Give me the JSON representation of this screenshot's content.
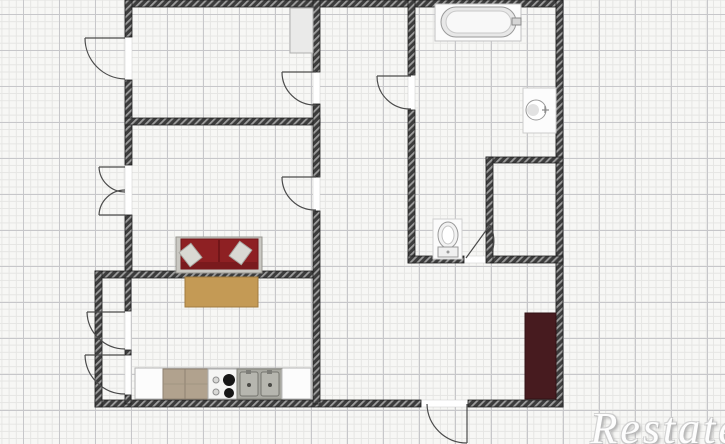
{
  "watermark": {
    "text": "Restate"
  },
  "plan": {
    "width": 725,
    "height": 444,
    "palette": {
      "wall_fill": "#3c3c3c",
      "wall_hatch": "#9d9d9d",
      "wall_edge": "#1e1e1e",
      "door": "#4b4b4b",
      "threshold": "#ffffff"
    },
    "walls": [
      {
        "x": 125,
        "y": 0,
        "w": 438,
        "h": 7
      },
      {
        "x": 556,
        "y": 0,
        "w": 7,
        "h": 407
      },
      {
        "x": 95,
        "y": 400,
        "w": 326,
        "h": 7
      },
      {
        "x": 468,
        "y": 400,
        "w": 95,
        "h": 7
      },
      {
        "x": 125,
        "y": 0,
        "w": 7,
        "h": 37
      },
      {
        "x": 125,
        "y": 80,
        "w": 7,
        "h": 85
      },
      {
        "x": 125,
        "y": 215,
        "w": 7,
        "h": 62
      },
      {
        "x": 95,
        "y": 271,
        "w": 225,
        "h": 7
      },
      {
        "x": 95,
        "y": 271,
        "w": 7,
        "h": 136
      },
      {
        "x": 125,
        "y": 118,
        "w": 195,
        "h": 7
      },
      {
        "x": 313,
        "y": 0,
        "w": 7,
        "h": 72
      },
      {
        "x": 313,
        "y": 104,
        "w": 7,
        "h": 73
      },
      {
        "x": 313,
        "y": 211,
        "w": 7,
        "h": 193
      },
      {
        "x": 408,
        "y": 0,
        "w": 7,
        "h": 75
      },
      {
        "x": 408,
        "y": 110,
        "w": 7,
        "h": 153
      },
      {
        "x": 408,
        "y": 256,
        "w": 56,
        "h": 7
      },
      {
        "x": 492,
        "y": 256,
        "w": 71,
        "h": 7
      },
      {
        "x": 486,
        "y": 157,
        "w": 77,
        "h": 6
      },
      {
        "x": 486,
        "y": 157,
        "w": 7,
        "h": 106
      },
      {
        "x": 125,
        "y": 278,
        "w": 6,
        "h": 33
      },
      {
        "x": 125,
        "y": 350,
        "w": 6,
        "h": 5
      },
      {
        "x": 125,
        "y": 395,
        "w": 6,
        "h": 9
      }
    ],
    "openings": [
      {
        "x": 125,
        "y": 37,
        "w": 7,
        "h": 43
      },
      {
        "x": 125,
        "y": 165,
        "w": 7,
        "h": 50
      },
      {
        "x": 313,
        "y": 72,
        "w": 7,
        "h": 32
      },
      {
        "x": 313,
        "y": 177,
        "w": 7,
        "h": 34
      },
      {
        "x": 408,
        "y": 75,
        "w": 7,
        "h": 35
      },
      {
        "x": 464,
        "y": 256,
        "w": 28,
        "h": 7
      },
      {
        "x": 125,
        "y": 311,
        "w": 6,
        "h": 39
      },
      {
        "x": 125,
        "y": 355,
        "w": 6,
        "h": 40
      },
      {
        "x": 421,
        "y": 400,
        "w": 47,
        "h": 7
      }
    ],
    "doors": [
      {
        "name": "door-upper-balcony",
        "leaf": [
          125,
          38,
          85,
          38
        ],
        "arc": {
          "from": [
            85,
            38
          ],
          "to": [
            125,
            79
          ],
          "r": 41,
          "sweep": 0
        }
      },
      {
        "name": "door-top-left-room",
        "leaf": [
          316,
          72,
          282,
          72
        ],
        "arc": {
          "from": [
            282,
            72
          ],
          "to": [
            316,
            105
          ],
          "r": 33,
          "sweep": 0
        }
      },
      {
        "name": "door-living-room",
        "leaf": [
          316,
          177,
          282,
          177
        ],
        "arc": {
          "from": [
            282,
            177
          ],
          "to": [
            316,
            210
          ],
          "r": 33,
          "sweep": 0
        }
      },
      {
        "name": "door-bathroom",
        "leaf": [
          411,
          76,
          377,
          76
        ],
        "arc": {
          "from": [
            377,
            76
          ],
          "to": [
            411,
            109
          ],
          "r": 33,
          "sweep": 0
        }
      },
      {
        "name": "door-bathroom-inner",
        "leaf": [
          466,
          258,
          490,
          225
        ],
        "arc": {
          "from": [
            490,
            225
          ],
          "to": [
            492,
            252
          ],
          "r": 34,
          "sweep": 1
        }
      },
      {
        "name": "door-french-upper-leaf",
        "leaf": [
          125,
          167,
          99,
          167
        ],
        "arc": {
          "from": [
            99,
            167
          ],
          "to": [
            125,
            192
          ],
          "r": 26,
          "sweep": 0
        }
      },
      {
        "name": "door-french-lower-leaf",
        "leaf": [
          125,
          215,
          99,
          215
        ],
        "arc": {
          "from": [
            99,
            215
          ],
          "to": [
            125,
            190
          ],
          "r": 26,
          "sweep": 1
        }
      },
      {
        "name": "door-closet-upper",
        "leaf": [
          125,
          312,
          87,
          312
        ],
        "arc": {
          "from": [
            87,
            312
          ],
          "to": [
            125,
            349
          ],
          "r": 38,
          "sweep": 0
        }
      },
      {
        "name": "door-closet-lower",
        "leaf": [
          125,
          355,
          85,
          355
        ],
        "arc": {
          "from": [
            85,
            355
          ],
          "to": [
            125,
            394
          ],
          "r": 40,
          "sweep": 0
        }
      },
      {
        "name": "door-entrance",
        "leaf": [
          467,
          404,
          467,
          443
        ],
        "arc": {
          "from": [
            467,
            443
          ],
          "to": [
            427,
            404
          ],
          "r": 40,
          "sweep": 1
        }
      }
    ],
    "furniture": [
      {
        "name": "cabinet",
        "shape": "rect",
        "x": 290,
        "y": 8,
        "w": 23,
        "h": 45,
        "fill": "#eaeae9",
        "stroke": "#b0b0b0"
      },
      {
        "name": "bathtub-base",
        "shape": "rect",
        "x": 435,
        "y": 4,
        "w": 86,
        "h": 37,
        "fill": "#fbfbfb",
        "stroke": "#c2c2c2"
      },
      {
        "name": "bathtub-rim",
        "shape": "rect",
        "x": 441,
        "y": 7,
        "w": 75,
        "h": 30,
        "rx": 15,
        "fill": "#e8e8e8",
        "stroke": "#9a9a9a"
      },
      {
        "name": "bathtub-inner",
        "shape": "rect",
        "x": 446,
        "y": 11,
        "w": 65,
        "h": 22,
        "rx": 11,
        "fill": "#f8f8f8",
        "stroke": "#c9c9c9"
      },
      {
        "name": "bathtub-faucet",
        "shape": "rect",
        "x": 512,
        "y": 18,
        "w": 9,
        "h": 7,
        "fill": "#d6d6d6",
        "stroke": "#8a8a8a"
      },
      {
        "name": "boiler-box",
        "shape": "rect",
        "x": 523,
        "y": 88,
        "w": 33,
        "h": 45,
        "fill": "#fcfcfc",
        "stroke": "#cccccc"
      },
      {
        "name": "boiler-dial",
        "shape": "circle",
        "cx": 536,
        "cy": 110,
        "r": 10,
        "fill": "#ffffff",
        "stroke": "#9a9a9a"
      },
      {
        "name": "boiler-dial-shade",
        "shape": "circle",
        "cx": 533,
        "cy": 110,
        "r": 6,
        "fill": "#e2e2e2",
        "stroke": "none"
      },
      {
        "name": "boiler-valve-h",
        "shape": "line",
        "x1": 542,
        "y1": 110,
        "x2": 549,
        "y2": 110,
        "stroke": "#8a8a8a",
        "sw": 1.2
      },
      {
        "name": "boiler-valve-v",
        "shape": "line",
        "x1": 545,
        "y1": 106,
        "x2": 545,
        "y2": 113,
        "stroke": "#8a8a8a",
        "sw": 1.2
      },
      {
        "name": "toilet-base",
        "shape": "rect",
        "x": 433,
        "y": 219,
        "w": 29,
        "h": 40,
        "fill": "#fbfbfb",
        "stroke": "#cfcfcf"
      },
      {
        "name": "toilet-bowl",
        "shape": "ellipse",
        "cx": 448,
        "cy": 235,
        "rx": 10,
        "ry": 13,
        "fill": "#f2f2f2",
        "stroke": "#9a9a9a"
      },
      {
        "name": "toilet-bowl-inner",
        "shape": "ellipse",
        "cx": 448,
        "cy": 235,
        "rx": 6,
        "ry": 9,
        "fill": "#ffffff",
        "stroke": "#c4c4c4"
      },
      {
        "name": "toilet-tank",
        "shape": "rect",
        "x": 438,
        "y": 247,
        "w": 20,
        "h": 10,
        "fill": "#f0f0f0",
        "stroke": "#9a9a9a"
      },
      {
        "name": "toilet-button",
        "shape": "circle",
        "cx": 448,
        "cy": 252,
        "r": 1.5,
        "fill": "#9a9a9a",
        "stroke": "none"
      },
      {
        "name": "sofa-frame",
        "shape": "rect",
        "x": 176,
        "y": 237,
        "w": 86,
        "h": 36,
        "fill": "#c9c8c2",
        "stroke": "#96958f"
      },
      {
        "name": "sofa-cushions",
        "shape": "rect",
        "x": 181,
        "y": 239,
        "w": 77,
        "h": 30,
        "fill": "#8e2023",
        "stroke": "#701418"
      },
      {
        "name": "sofa-cushion-split",
        "shape": "line",
        "x1": 219,
        "y1": 240,
        "x2": 219,
        "y2": 268,
        "stroke": "#5f1013",
        "sw": 1.2
      },
      {
        "name": "sofa-back",
        "shape": "rect",
        "x": 181,
        "y": 262,
        "w": 77,
        "h": 7,
        "fill": "#7a1a1d",
        "stroke": "none"
      },
      {
        "name": "sofa-pillow-left",
        "shape": "rect",
        "x": 183,
        "y": 246,
        "w": 15,
        "h": 18,
        "rotate": -38,
        "fill": "#d9d9d3",
        "stroke": "#a8a8a2"
      },
      {
        "name": "sofa-pillow-right",
        "shape": "rect",
        "x": 233,
        "y": 244,
        "w": 15,
        "h": 18,
        "rotate": 36,
        "fill": "#d9d9d3",
        "stroke": "#a8a8a2"
      },
      {
        "name": "table-dining",
        "shape": "rect",
        "x": 185,
        "y": 277,
        "w": 73,
        "h": 30,
        "fill": "#c49a55",
        "stroke": "#a07b3e"
      },
      {
        "name": "kitchen-counter",
        "shape": "rect",
        "x": 135,
        "y": 368,
        "w": 176,
        "h": 31,
        "fill": "#fcfcfc",
        "stroke": "#b5b5b5"
      },
      {
        "name": "kitchen-cabinet-wood",
        "shape": "rect",
        "x": 163,
        "y": 369,
        "w": 45,
        "h": 30,
        "fill": "#b1a28e",
        "stroke": "#8e8171"
      },
      {
        "name": "kitchen-cabinet-split-v",
        "shape": "line",
        "x1": 185,
        "y1": 369,
        "x2": 185,
        "y2": 399,
        "stroke": "#8e8171",
        "sw": 1
      },
      {
        "name": "kitchen-cabinet-split-h",
        "shape": "line",
        "x1": 163,
        "y1": 384,
        "x2": 208,
        "y2": 384,
        "stroke": "#9d907d",
        "sw": 0.8
      },
      {
        "name": "kitchen-stove",
        "shape": "rect",
        "x": 208,
        "y": 369,
        "w": 29,
        "h": 30,
        "fill": "#f5f5f4",
        "stroke": "#adadad"
      },
      {
        "name": "stove-burner-small-top",
        "shape": "circle",
        "cx": 216,
        "cy": 380,
        "r": 3,
        "fill": "#d8d8d6",
        "stroke": "#8f8f8f"
      },
      {
        "name": "stove-burner-large-top",
        "shape": "circle",
        "cx": 229,
        "cy": 380,
        "r": 6,
        "fill": "#161616",
        "stroke": "none"
      },
      {
        "name": "stove-burner-small-bottom",
        "shape": "circle",
        "cx": 216,
        "cy": 392,
        "r": 3,
        "fill": "#d8d8d6",
        "stroke": "#8f8f8f"
      },
      {
        "name": "stove-burner-large-bottom",
        "shape": "circle",
        "cx": 229,
        "cy": 393,
        "r": 5,
        "fill": "#161616",
        "stroke": "none"
      },
      {
        "name": "kitchen-sink-unit",
        "shape": "rect",
        "x": 237,
        "y": 369,
        "w": 45,
        "h": 30,
        "fill": "#a8a8a1",
        "stroke": "#83837c"
      },
      {
        "name": "sink-basin-left",
        "shape": "rect",
        "x": 240,
        "y": 372,
        "w": 18,
        "h": 24,
        "rx": 2,
        "fill": "#b6b6af",
        "stroke": "#75756f"
      },
      {
        "name": "sink-basin-right",
        "shape": "rect",
        "x": 261,
        "y": 372,
        "w": 18,
        "h": 24,
        "rx": 2,
        "fill": "#b6b6af",
        "stroke": "#75756f"
      },
      {
        "name": "sink-drain-left",
        "shape": "circle",
        "cx": 249,
        "cy": 385,
        "r": 2,
        "fill": "#4a4a46",
        "stroke": "none"
      },
      {
        "name": "sink-drain-right",
        "shape": "circle",
        "cx": 270,
        "cy": 385,
        "r": 2,
        "fill": "#4a4a46",
        "stroke": "none"
      },
      {
        "name": "sink-faucet-left",
        "shape": "rect",
        "x": 246,
        "y": 370,
        "w": 5,
        "h": 4,
        "fill": "#7d7d78",
        "stroke": "none"
      },
      {
        "name": "sink-faucet-right",
        "shape": "rect",
        "x": 267,
        "y": 370,
        "w": 5,
        "h": 4,
        "fill": "#7d7d78",
        "stroke": "none"
      },
      {
        "name": "kitchen-cabinet-divider",
        "shape": "line",
        "x1": 282,
        "y1": 369,
        "x2": 282,
        "y2": 399,
        "stroke": "#bdbdbd",
        "sw": 1
      },
      {
        "name": "wardrobe",
        "shape": "rect",
        "x": 525,
        "y": 313,
        "w": 31,
        "h": 86,
        "fill": "#471b1f",
        "stroke": "#301114"
      }
    ]
  }
}
